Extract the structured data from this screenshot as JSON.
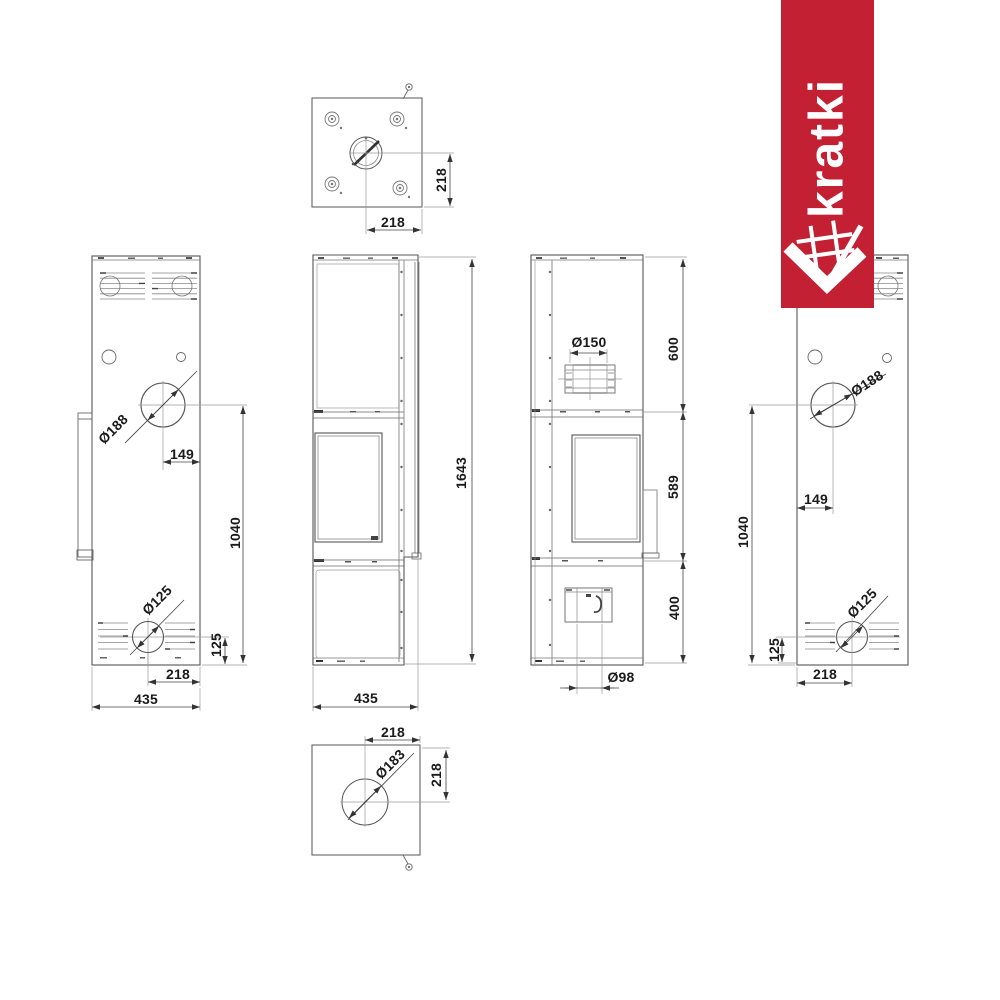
{
  "brand": {
    "name": "kratki",
    "color": "#c32034"
  },
  "views": {
    "top": {
      "title": "top-view",
      "dim_offset_x": "218",
      "dim_offset_y": "218"
    },
    "back_left": {
      "title": "back-view",
      "dim_flue_diameter": "Ø188",
      "dim_flue_offset": "149",
      "dim_flue_center_height": "1040",
      "dim_inlet_diameter": "Ø125",
      "dim_inlet_center_height": "125",
      "dim_inlet_offset": "218",
      "dim_width": "435"
    },
    "front": {
      "title": "front-view",
      "dim_total_height": "1643",
      "dim_width": "435"
    },
    "side": {
      "title": "side-view",
      "dim_flue_stub_diameter": "Ø150",
      "dim_top_section": "600",
      "dim_middle_section": "589",
      "dim_bottom_section": "400",
      "dim_air_inlet_diameter": "Ø98"
    },
    "back_right": {
      "title": "back-view-mirrored",
      "dim_flue_diameter": "Ø188",
      "dim_flue_offset": "149",
      "dim_flue_center_height": "1040",
      "dim_inlet_diameter": "Ø125",
      "dim_inlet_center_height": "125",
      "dim_inlet_offset": "218"
    },
    "bottom": {
      "title": "bottom-view",
      "dim_offset_x": "218",
      "dim_hole_diameter": "Ø183",
      "dim_offset_y": "218"
    }
  }
}
